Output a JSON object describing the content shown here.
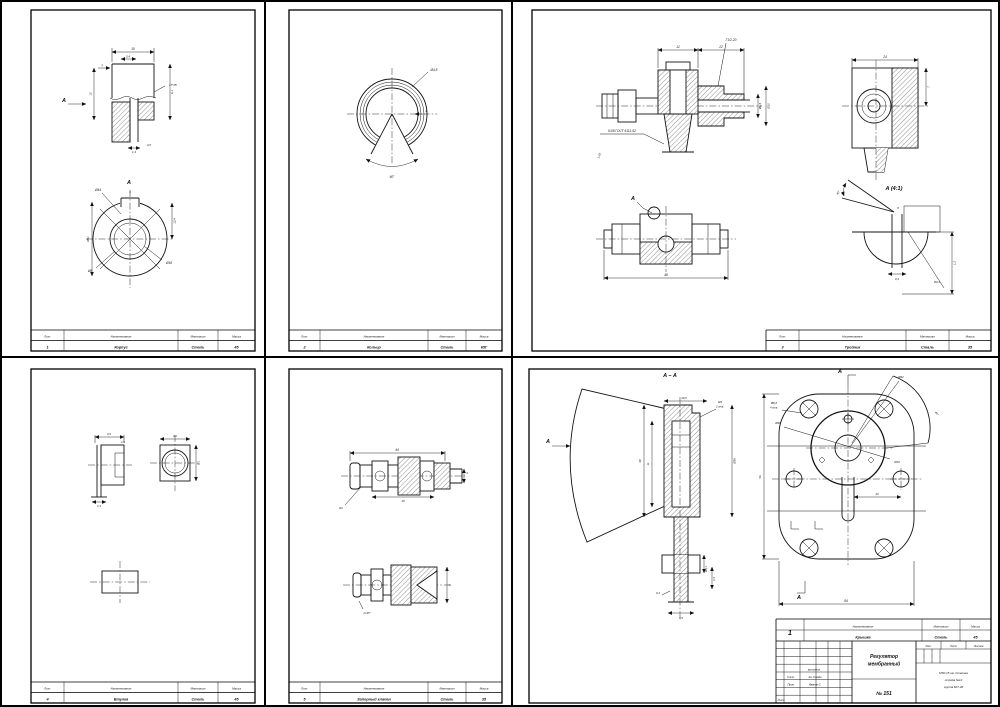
{
  "tb": {
    "h_pos": "Лит.",
    "h_name": "Наименование",
    "h_mat": "Материал",
    "h_mass": "Масса"
  },
  "s1": {
    "pos": "1",
    "name": "Корпус",
    "mat": "Сталь",
    "mass": "45",
    "sec_a": "A",
    "view_a": "A",
    "d1": "10",
    "d2": "5,4",
    "d3": "1",
    "d4": "17°45'",
    "d5": "6,1",
    "d6": "12",
    "d7": "1,3",
    "d8": "4,5",
    "d9": "Ø44",
    "d10": "Ø8",
    "d11": "Ø18",
    "d12": "Ø51",
    "d13": "12,4",
    "d14": "4"
  },
  "s2": {
    "pos": "2",
    "name": "Кольцо",
    "mat": "Сталь",
    "mass": "65Г",
    "d1": "Ø4,5",
    "d2": "60°",
    "d3": "3"
  },
  "s3": {
    "pos": "3",
    "name": "Тройник",
    "mat": "Сталь",
    "mass": "35",
    "view_a": "A",
    "detail": "A (4:1)",
    "d1": "12",
    "d2": "22",
    "d3": "Г1/2-20",
    "d4": "К1/8 ГОСТ 6111-52",
    "d5": "1,25",
    "d6": "Ø6,4",
    "d7": "Ø10",
    "d8": "24",
    "d9": "7",
    "d10": "48",
    "d11": "40°",
    "d12": "0,4",
    "d13": "R0,4",
    "d14": "1,2",
    "d15": "8"
  },
  "s4": {
    "pos": "4",
    "name": "Втулка",
    "mat": "Сталь",
    "mass": "45",
    "d1": "4,5",
    "d2": "1,5",
    "d3": "1,3",
    "d4": "3,2",
    "d5": "8,1"
  },
  "s5": {
    "pos": "5",
    "name": "Запорный клапан",
    "mat": "Сталь",
    "mass": "35",
    "d1": "44",
    "d2": "18",
    "d3": "R2",
    "d4": "4",
    "d5": "1×45°",
    "d6": "6"
  },
  "s6": {
    "sec_aa": "A – A",
    "view_a1": "A",
    "view_a2": "A",
    "view_a3": "A",
    "d1": "10,5",
    "d2": "М3",
    "d2b": "2 отв.",
    "d3": "Ø38",
    "d4": "38",
    "d5": "11",
    "d6": "3,5",
    "d7": "0,4",
    "d8": "Ø3,1",
    "d9": "1,4",
    "p1": "Ø6,6",
    "p1b": "4 отв.",
    "p2": "Ø32",
    "p3": "Ø30",
    "p4": "Ø10",
    "p5": "56",
    "p6": "84",
    "p7": "23",
    "p8": "45°"
  },
  "s6tb": {
    "pos": "1",
    "name": "Крышка",
    "mat": "Сталь",
    "mass": "45",
    "title1": "Регулятор",
    "title2": "мембранный",
    "doc_no": "№ 151",
    "r1l": "Сост.",
    "r1v": "Ан. Семён",
    "r2l": "Пров.",
    "r2v": "Иванов С.",
    "cell": "выполнил",
    "bl": "Лист",
    "lit": "Лит.",
    "list": "Лист",
    "listov": "Листов",
    "org1": "МТИ 15 им. Сталина",
    "org2": "отряда №12",
    "org3": "группа 62Т-4б"
  }
}
